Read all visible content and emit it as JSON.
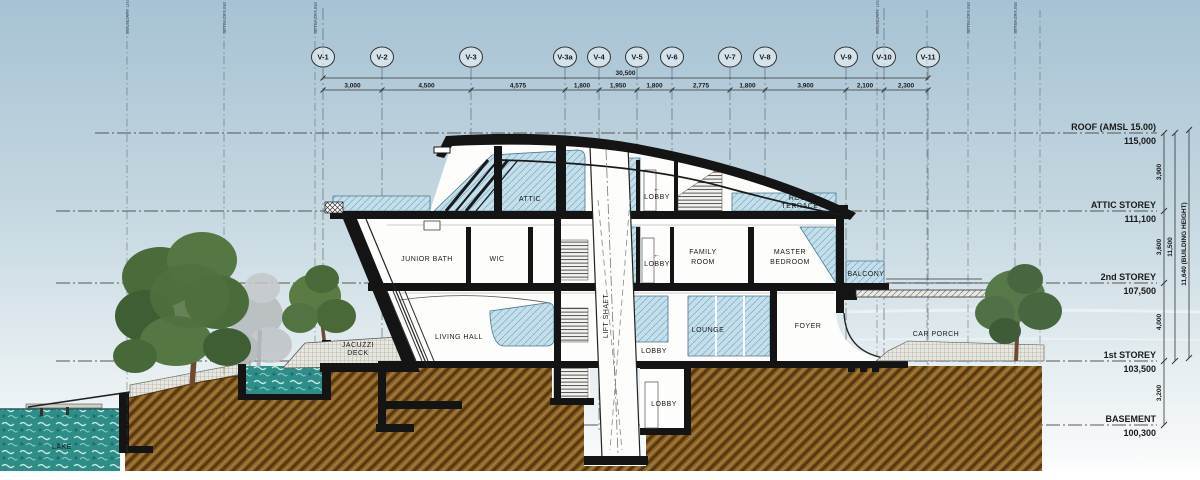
{
  "drawing_title": "Building section",
  "colors": {
    "sky_top": "#a6c2d4",
    "sky_low": "#eef3f5",
    "earth": "#8a6126",
    "water": "#2e8d89",
    "glass": "#c3dfeb",
    "line": "#1a1a1a"
  },
  "grid": {
    "bubble_y": 57,
    "items": [
      {
        "label": "V-1",
        "x": 323
      },
      {
        "label": "V-2",
        "x": 382
      },
      {
        "label": "V-3",
        "x": 471
      },
      {
        "label": "V-3a",
        "x": 565
      },
      {
        "label": "V-4",
        "x": 599
      },
      {
        "label": "V-5",
        "x": 637
      },
      {
        "label": "V-6",
        "x": 672
      },
      {
        "label": "V-7",
        "x": 730
      },
      {
        "label": "V-8",
        "x": 765
      },
      {
        "label": "V-9",
        "x": 846
      },
      {
        "label": "V-10",
        "x": 884
      },
      {
        "label": "V-11",
        "x": 928
      }
    ]
  },
  "top_dims": {
    "total": {
      "label": "30,500",
      "y": 78
    },
    "segment_y": 90,
    "segments": [
      "3,000",
      "4,500",
      "4,575",
      "1,800",
      "1,950",
      "1,800",
      "2,775",
      "1,800",
      "3,900",
      "2,100",
      "2,300"
    ]
  },
  "levels": [
    {
      "name": "ROOF (AMSL 15.00)",
      "value": "115,000",
      "y": 133,
      "x_start": 95
    },
    {
      "name": "ATTIC STOREY",
      "value": "111,100",
      "y": 211,
      "x_start": 56
    },
    {
      "name": "2nd STOREY",
      "value": "107,500",
      "y": 283,
      "x_start": 56
    },
    {
      "name": "1st STOREY",
      "value": "103,500",
      "y": 361,
      "x_start": 56
    },
    {
      "name": "BASEMENT",
      "value": "100,300",
      "y": 425,
      "x_start": 56
    }
  ],
  "vertical_dims": {
    "chain_x": 1164,
    "chain": [
      {
        "label": "3,900",
        "from": 133,
        "to": 211
      },
      {
        "label": "3,600",
        "from": 211,
        "to": 283
      },
      {
        "label": "4,000",
        "from": 283,
        "to": 361
      },
      {
        "label": "3,200",
        "from": 361,
        "to": 425
      }
    ],
    "overall": {
      "label": "11,500",
      "from": 133,
      "to": 361,
      "x": 1175
    },
    "building_height": {
      "label": "11,640 (BUILDING HEIGHT)",
      "from": 130,
      "to": 358,
      "x": 1189
    }
  },
  "rooms": [
    {
      "t": "ATTIC",
      "x": 530,
      "y": 201
    },
    {
      "t": "←",
      "x": 657,
      "y": 191,
      "s": 8
    },
    {
      "t": "LOBBY",
      "x": 657,
      "y": 199
    },
    {
      "t": "ROOF",
      "x": 800,
      "y": 200,
      "s": 6.5
    },
    {
      "t": "TERRACE",
      "x": 800,
      "y": 208,
      "s": 6.5
    },
    {
      "t": "JUNIOR BATH",
      "x": 427,
      "y": 261
    },
    {
      "t": "WIC",
      "x": 497,
      "y": 261
    },
    {
      "t": "←",
      "x": 657,
      "y": 257,
      "s": 8
    },
    {
      "t": "LOBBY",
      "x": 657,
      "y": 266
    },
    {
      "t": "FAMILY",
      "x": 703,
      "y": 254
    },
    {
      "t": "ROOM",
      "x": 703,
      "y": 264
    },
    {
      "t": "MASTER",
      "x": 790,
      "y": 254
    },
    {
      "t": "BEDROOM",
      "x": 790,
      "y": 264
    },
    {
      "t": "BALCONY",
      "x": 866,
      "y": 276,
      "s": 6.5
    },
    {
      "t": "LIVING HALL",
      "x": 459,
      "y": 339
    },
    {
      "t": "LOUNGE",
      "x": 708,
      "y": 332
    },
    {
      "t": "LOBBY",
      "x": 654,
      "y": 353,
      "s": 6.5
    },
    {
      "t": "FOYER",
      "x": 808,
      "y": 328
    },
    {
      "t": "CAR PORCH",
      "x": 936,
      "y": 336
    },
    {
      "t": "LOBBY",
      "x": 664,
      "y": 406,
      "s": 6.5
    },
    {
      "t": "JACUZZI",
      "x": 358,
      "y": 347,
      "s": 6.5
    },
    {
      "t": "DECK",
      "x": 358,
      "y": 355,
      "s": 6.5
    },
    {
      "t": "LAKE",
      "x": 62,
      "y": 449
    },
    {
      "t": "LIFT SHAFT",
      "x": 608,
      "y": 316,
      "rot": -90,
      "s": 7.5,
      "sp": 2
    }
  ],
  "site": {
    "lot_lines": [
      {
        "x": 127,
        "label": "BOUNDARY LINE"
      },
      {
        "x": 224,
        "label": "SETBACK LINE"
      },
      {
        "x": 315,
        "label": "SETBACK LINE"
      },
      {
        "x": 877,
        "label": "BOUNDARY LINE"
      },
      {
        "x": 927,
        "label": ""
      },
      {
        "x": 968,
        "label": "SETBACK LINE"
      },
      {
        "x": 1015,
        "label": "SETBACK LINE"
      },
      {
        "x": 1040,
        "label": ""
      }
    ]
  }
}
